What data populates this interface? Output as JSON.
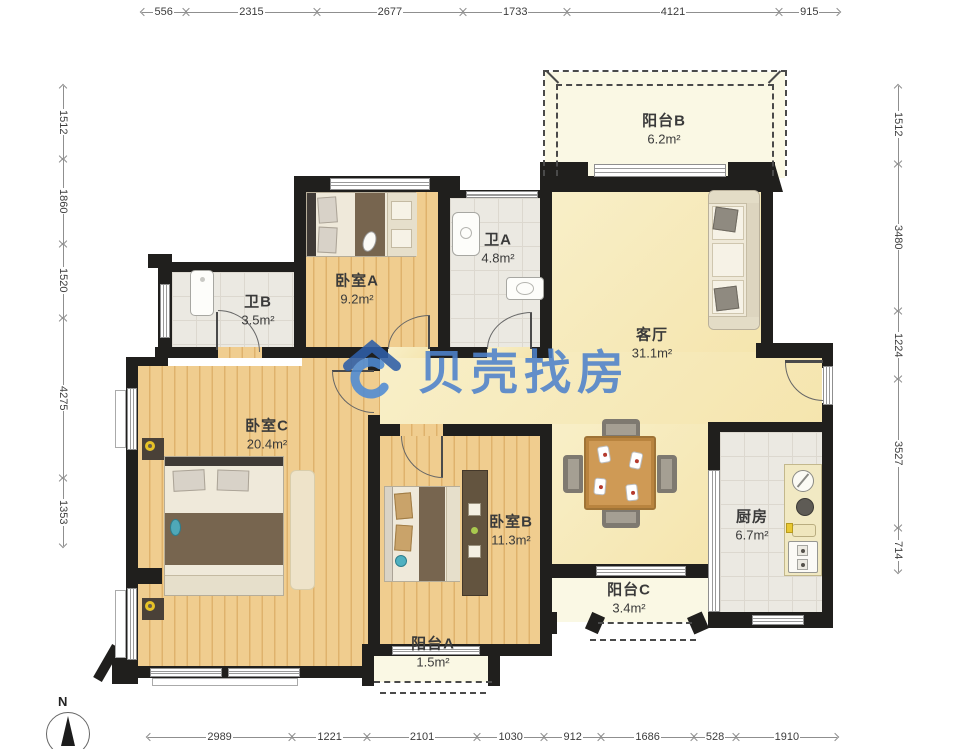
{
  "watermark": {
    "text": "贝壳找房",
    "icon": "beike-house-icon",
    "color": "#4e82cb"
  },
  "compass": {
    "label": "N"
  },
  "rooms": [
    {
      "id": "balcony-b",
      "name": "阳台B",
      "area": "6.2m²"
    },
    {
      "id": "bath-a",
      "name": "卫A",
      "area": "4.8m²"
    },
    {
      "id": "bedroom-a",
      "name": "卧室A",
      "area": "9.2m²"
    },
    {
      "id": "bath-b",
      "name": "卫B",
      "area": "3.5m²"
    },
    {
      "id": "living",
      "name": "客厅",
      "area": "31.1m²"
    },
    {
      "id": "bedroom-c",
      "name": "卧室C",
      "area": "20.4m²"
    },
    {
      "id": "bedroom-b",
      "name": "卧室B",
      "area": "11.3m²"
    },
    {
      "id": "kitchen",
      "name": "厨房",
      "area": "6.7m²"
    },
    {
      "id": "balcony-c",
      "name": "阳台C",
      "area": "3.4m²"
    },
    {
      "id": "balcony-a",
      "name": "阳台A",
      "area": "1.5m²"
    }
  ],
  "dimensions": {
    "top": [
      556,
      2315,
      2677,
      1733,
      4121,
      915
    ],
    "bottom": [
      2989,
      1221,
      2101,
      1030,
      912,
      1686,
      528,
      1910
    ],
    "left": [
      1512,
      1860,
      1520,
      4275,
      1353
    ],
    "right": [
      1512,
      3480,
      1224,
      3527,
      714
    ]
  },
  "colors": {
    "wall": "#201f1d",
    "wood_floor": "#f0cd8f",
    "living_floor": "#f7ecc2",
    "balcony_floor": "#faf8e4",
    "tile_floor": "#ebe9e2",
    "dimension_line": "#8f8f8f",
    "watermark_blue": "#4e82cb"
  }
}
